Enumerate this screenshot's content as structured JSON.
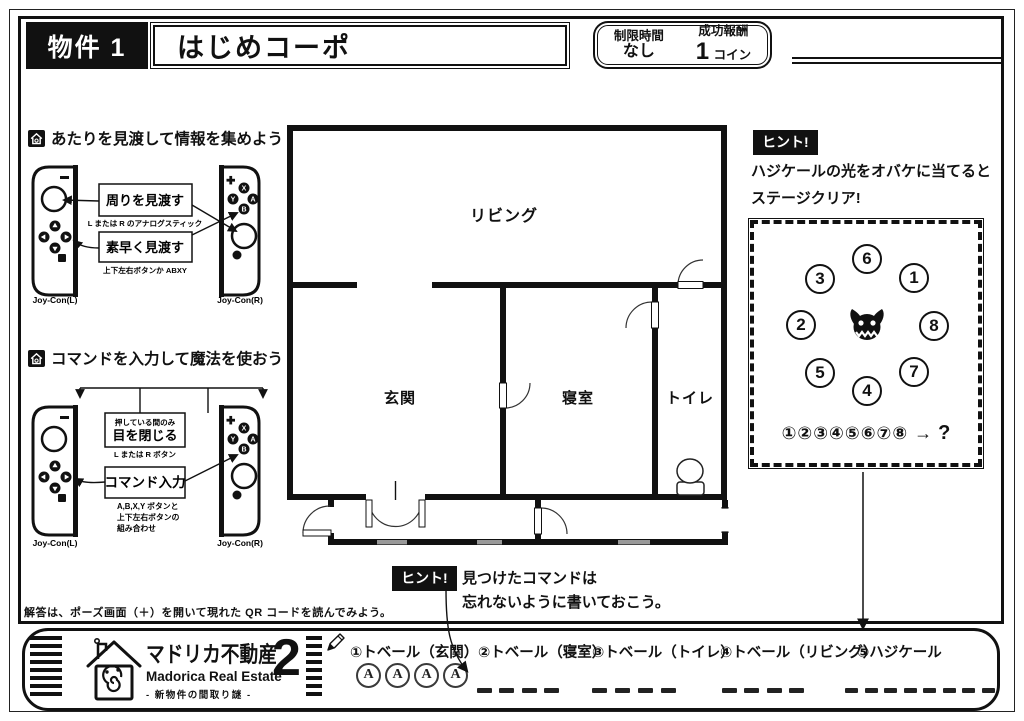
{
  "header": {
    "property_label": "物件 1",
    "property_name": "はじめコーポ",
    "time_limit_label": "制限時間",
    "time_limit_value": "なし",
    "reward_label": "成功報酬",
    "reward_value": "1",
    "reward_unit": "コイン"
  },
  "joycon_buttons": {
    "x": "X",
    "y": "Y",
    "a": "A",
    "b": "B"
  },
  "sections": {
    "look": {
      "title": "あたりを見渡して情報を集めよう",
      "box_look_around": "周りを見渡す",
      "caption_look_around": "L または R のアナログスティック",
      "box_quick_look": "素早く見渡す",
      "caption_quick_look": "上下左右ボタンか ABXY",
      "joycon_l": "Joy-Con(L)",
      "joycon_r": "Joy-Con(R)"
    },
    "command": {
      "title": "コマンドを入力して魔法を使おう",
      "box_close_eyes_note": "押している間のみ",
      "box_close_eyes": "目を閉じる",
      "caption_close_eyes": "L または R ボタン",
      "box_command": "コマンド入力",
      "caption_command_1": "A,B,X,Y ボタンと",
      "caption_command_2": "上下左右ボタンの",
      "caption_command_3": "組み合わせ",
      "joycon_l": "Joy-Con(L)",
      "joycon_r": "Joy-Con(R)"
    }
  },
  "floorplan": {
    "rooms": {
      "living": "リビング",
      "entrance": "玄関",
      "bedroom": "寝室",
      "toilet": "トイレ"
    }
  },
  "hint_right": {
    "badge": "ヒント!",
    "line1": "ハジケールの光をオバケに当てると",
    "line2": "ステージクリア!",
    "positions": [
      "6",
      "3",
      "1",
      "2",
      "8",
      "5",
      "7",
      "4"
    ],
    "sequence": "①②③④⑤⑥⑦⑧",
    "arrow": "→",
    "question": "?"
  },
  "hint_bottom": {
    "badge": "ヒント!",
    "line1": "見つけたコマンドは",
    "line2": "忘れないように書いておこう。"
  },
  "note": "解答は、ポーズ画面（＋）を開いて現れた QR コードを読んでみよう。",
  "footer": {
    "logo_jp": "マドリカ不動産",
    "logo_number": "2",
    "logo_en": "Madorica Real Estate",
    "logo_sub": "- 新物件の間取り謎 -",
    "commands": [
      {
        "label": "①トベール（玄関）",
        "answer": [
          "A",
          "A",
          "A",
          "A"
        ]
      },
      {
        "label": "②トベール（寝室）"
      },
      {
        "label": "③トベール（トイレ）"
      },
      {
        "label": "④トベール（リビング）"
      },
      {
        "label": "⑤ハジケール"
      }
    ]
  }
}
